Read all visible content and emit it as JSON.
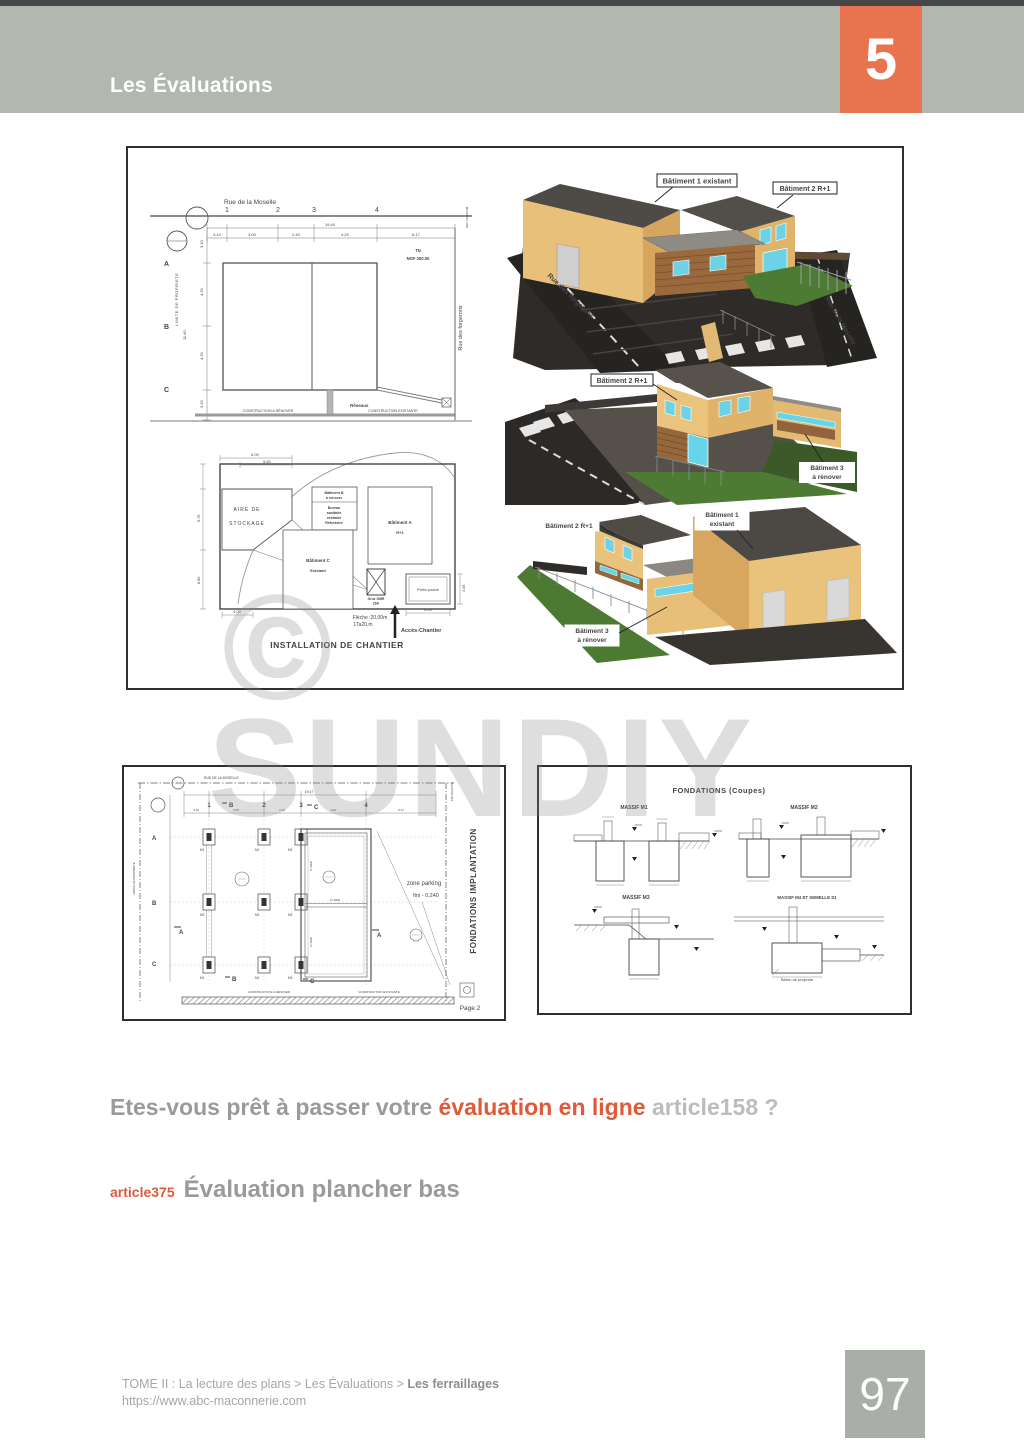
{
  "colors": {
    "accent_orange": "#e8734e",
    "highlight_orange": "#dd5b38",
    "header_gray": "#b2b7b0",
    "page_box_gray": "#a9aea9",
    "text_gray": "#9a9a9a",
    "text_light_gray": "#bcbcbc"
  },
  "header": {
    "title": "Les Évaluations",
    "chapter": "5"
  },
  "watermark": {
    "symbol": "©",
    "text": "SUNDIY"
  },
  "question": {
    "prefix": "Etes-vous prêt à passer votre ",
    "highlight": "évaluation en ligne",
    "suffix": " article158 ?"
  },
  "article": {
    "tag": "article375",
    "title": "Évaluation plancher bas"
  },
  "footer": {
    "breadcrumb": "TOME II : La lecture des plans > Les Évaluations > ",
    "breadcrumb_bold": "Les ferraillages",
    "url": "https://www.abc-maconnerie.com",
    "page": "97"
  },
  "site_plan": {
    "street_top": "Rue de la Moselle",
    "cols": [
      "1",
      "2",
      "3",
      "4"
    ],
    "rows": [
      "A",
      "B",
      "C"
    ],
    "dims_top": [
      "3.10",
      "3.00",
      "2.40",
      "4.20",
      "6.17"
    ],
    "dim_total": "19.40",
    "dims_left": [
      "3.10",
      "4.20",
      "4.20",
      "3.15"
    ],
    "dim_left_total": "11.60",
    "tn": "TN",
    "ngf": "NGF 200.00",
    "limite": "LIMITE DE PROPRIETE",
    "reseaux": "Réseaux",
    "note_renover": "CONSTRUCTION A RÉNOVER",
    "note_existante": "CONSTRUCTION EXISTANTE",
    "street_right": "Rue des forgerons",
    "corner": "EDF TELECOM"
  },
  "chantier": {
    "title": "INSTALLATION DE CHANTIER",
    "aire1": "AIRE DE",
    "aire2": "STOCKAGE",
    "bat_b": [
      "Bâtiment B",
      "à rénover",
      "Bureau",
      "sanitaire",
      "vestiaire",
      "Réfectoire"
    ],
    "bat_a1": "Bâtiment A",
    "bat_a2": "R+1",
    "bat_c1": "Bâtiment C",
    "bat_c2": "Existant",
    "grue1": "Grue GMR",
    "grue2": "28A",
    "poutre": "Préfa poutre",
    "fleche1": "Flèche :20,00m",
    "fleche2": "1Ta20,m",
    "acces": "Accès-Chantier",
    "dim_top1": "6.00",
    "dim_top2": "5.50",
    "dim_left1": "5.75",
    "dim_left2": "8.60",
    "dim_bottom1": "4.00",
    "dim_bottom2": "6.00",
    "dim_right": "4.05"
  },
  "renders": {
    "r1": {
      "label1": "Bâtiment 1 existant",
      "label2": "Bâtiment 2 R+1",
      "street_left": "Rue des forgerons",
      "street_right": "Rue de la Moselle"
    },
    "r2": {
      "label1": "Bâtiment 2 R+1",
      "label2a": "Bâtiment 3",
      "label2b": "à rénover"
    },
    "r3": {
      "label1": "Bâtiment 2 R+1",
      "label2a": "Bâtiment 1",
      "label2b": "existant",
      "label3a": "Bâtiment 3",
      "label3b": "à rénover"
    }
  },
  "implantation": {
    "side_title": "FONDATIONS IMPLANTATION",
    "street_top": "RUE DE LA MOSELLE",
    "cols": [
      "1",
      "2",
      "3",
      "4"
    ],
    "rows": [
      "A",
      "B",
      "C"
    ],
    "dims_top": [
      "3.10",
      "3.00",
      "2.40",
      "4.20",
      "6.17"
    ],
    "dim_total": "19.47",
    "section_b": "B",
    "section_c": "C",
    "section_a": "A",
    "footings": [
      [
        "M1",
        "M1",
        "M2"
      ],
      [
        "M2",
        "M2",
        "M3"
      ],
      [
        "M1",
        "M1",
        "M3"
      ]
    ],
    "longrine": "LT 40/30",
    "zone1": "zone parking",
    "zone2": "fini   - 0,240",
    "limite": "LIMITE DE PROPRIETE",
    "corner": "EDF TELECOM",
    "note_renover": "CONSTRUCTION A RÉNOVER",
    "note_existante": "CONSTRUCTION EXISTANTE",
    "page": "Page 2"
  },
  "coupes": {
    "title": "FONDATIONS (Coupes)",
    "m1": "MASSIF M1",
    "m2": "MASSIF M2",
    "m3": "MASSIF M3",
    "m4": "MASSIF M4 ET SEMELLE S1",
    "caption": "Béton de propreté"
  }
}
